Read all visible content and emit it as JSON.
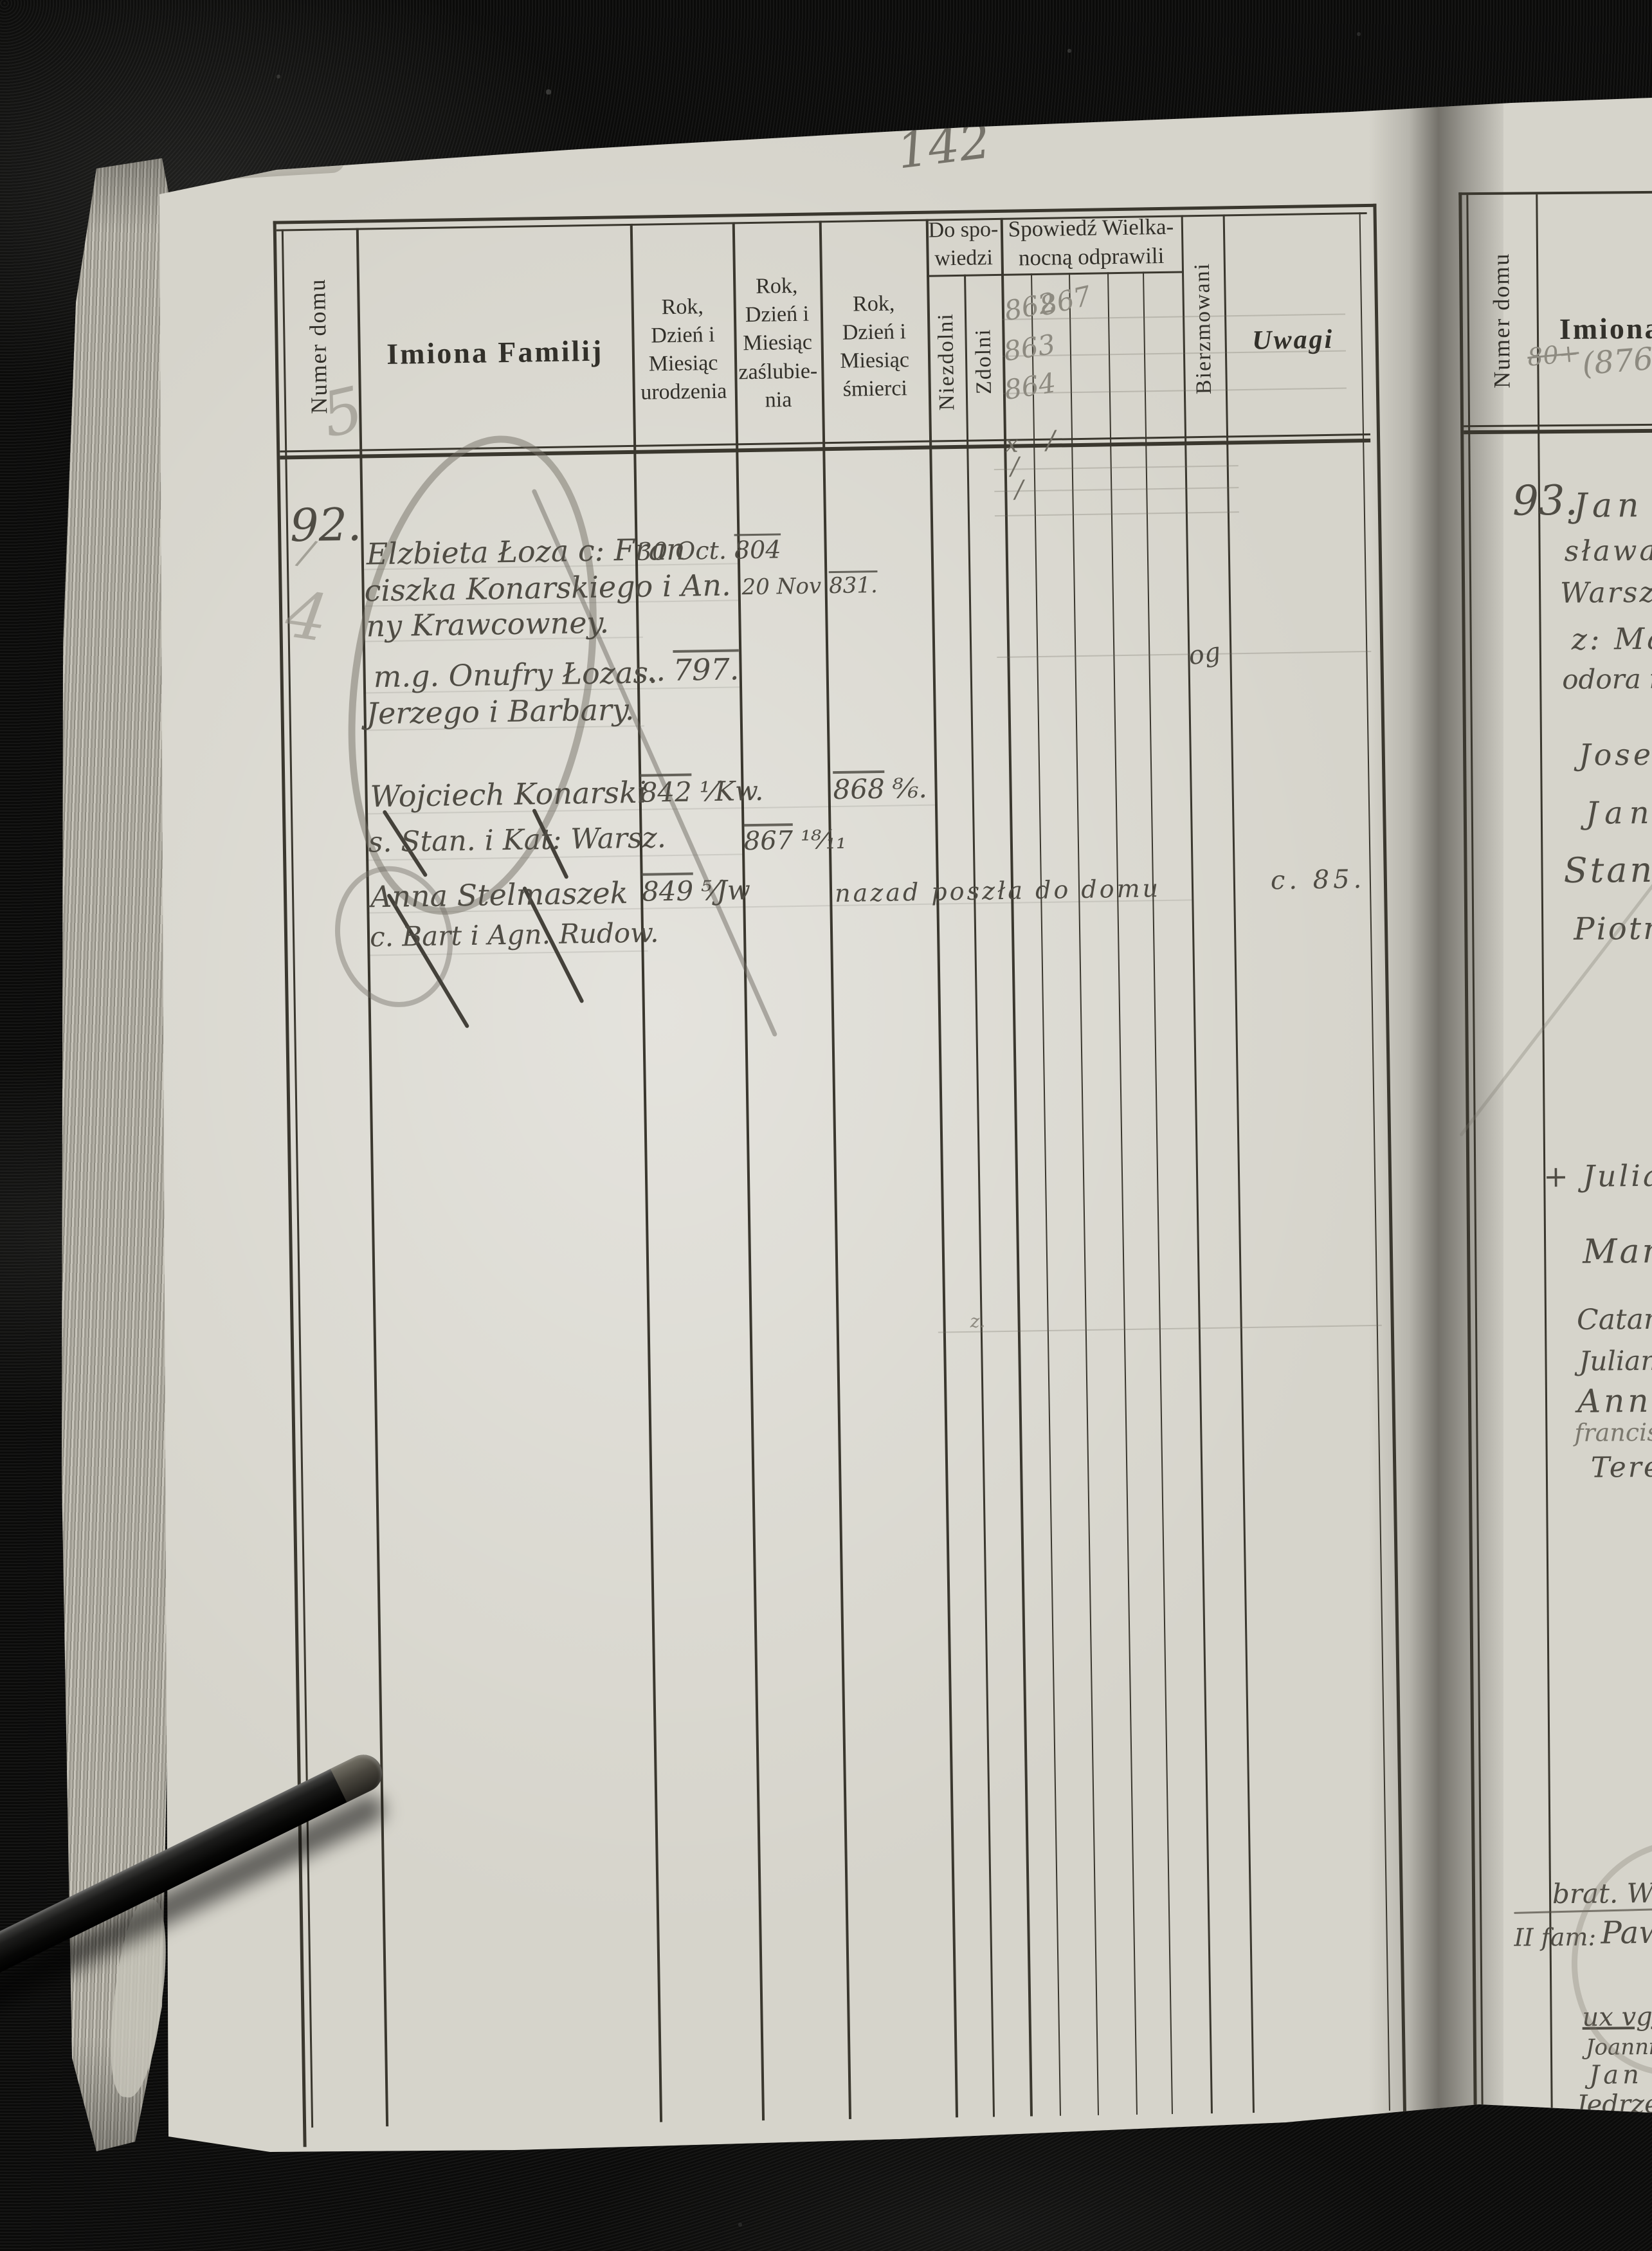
{
  "palette": {
    "paper": "#d6d4cb",
    "ink": "#4f4c44",
    "pencil": "#8d8a80",
    "leather": "#0a0a09",
    "rule": "#3a372e"
  },
  "page": {
    "pencil_page_number": "142",
    "ink_page_label": "pag 198."
  },
  "left_header": {
    "numer_domu": "Numer domu",
    "imiona_familij": "Imiona Familij",
    "urodzenia": "Rok,\nDzień i\nMiesiąc\nurodzenia",
    "zaslubienia": "Rok,\nDzień i\nMiesiąc\nzaślubie-\nnia",
    "smierci": "Rok,\nDzień i\nMiesiąc\nśmierci",
    "do_spowiedzi": "Do spo-\nwiedzi",
    "niezdolni": "Niezdolni",
    "zdolni": "Zdolni",
    "spowiedz": "Spowiedź Wielka-\nnocną odprawili",
    "bierzmowani": "Bierzmowani",
    "uwagi": "Uwagi"
  },
  "pencil_marks": {
    "five": "5",
    "dash": "∕",
    "four": "4",
    "spow_862": "862",
    "spow_867": "867",
    "spow_863": "863",
    "spow_864": "864",
    "conf_x": "x",
    "conf_s1": "/",
    "conf_s2": "/",
    "conf_s3": "/",
    "small_z": "z."
  },
  "entry92": {
    "number": "92.",
    "rows": {
      "l1_name": "Elzbieta Łoza c: Fran",
      "l1_birth_day": "30 Oct.",
      "l1_birth_year": "804",
      "l2_name": "ciszka Konarskiego i An.",
      "l2_marr_day": "20 Nov",
      "l2_marr_year": "831.",
      "l3_name": "ny Krawcowney.",
      "l4_name": "m.g. Onufry Łozas.",
      "l4_birth_dots": "..",
      "l4_birth_year": "797.",
      "l4_bierzmowani": "og",
      "l5_name": "Jerzego i Barbary.",
      "l6_name": "Wojciech Konarski",
      "l6_birth_year": "842",
      "l6_birth_frac": "¹⁄Kw.",
      "l6_death_year": "868",
      "l6_death_frac": "⁸⁄₆.",
      "l7_name": "s. Stan. i Kat: Warsz.",
      "l7_marr_year": "867",
      "l7_marr_frac": "¹⁸⁄₁₁",
      "l8_name": "Anna Stelmaszek",
      "l8_birth_year": "849",
      "l8_birth_frac": "⁵⁄Jw",
      "l8_note": "nazad poszła do domu",
      "l8_uwagi": "c. 85.",
      "l9_name": "c. Bart i Agn. Rudow."
    }
  },
  "right_page": {
    "header": {
      "numer_domu": "Numer domu",
      "imiona": "Imiona"
    },
    "pencil_crossed": "80+",
    "pencil_number": "(876–",
    "entry_number": "93.",
    "fam_label": "II fam:",
    "fam_name": "Pawił S",
    "lines": [
      "Jan Kon",
      "sława i S",
      "Warszaw",
      "z: Maria",
      "odora i Ma",
      "Josef S.",
      "Jan",
      "Stanis",
      "Piotr.",
      "+ Juliann",
      "Marya",
      "Catarin",
      "Juliann",
      "Anna",
      "francis",
      "Teres",
      "brat. Woyc: h",
      "ux vgr: R",
      "Joannis et",
      "Jan  s—",
      "Jędrzej s—"
    ]
  }
}
